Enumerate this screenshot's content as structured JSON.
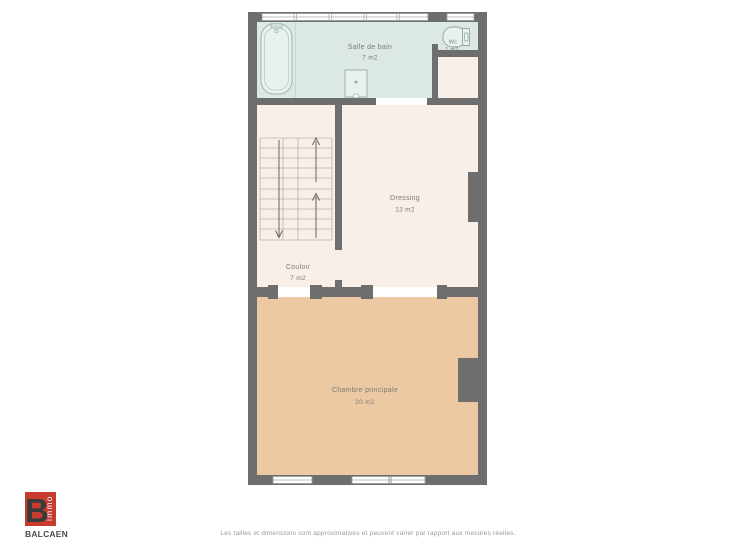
{
  "plan": {
    "rooms": [
      {
        "name": "Salle de bain",
        "area": "7 m2"
      },
      {
        "name": "Wc",
        "area": "1 m2"
      },
      {
        "name": "Dressing",
        "area": "13 m2"
      },
      {
        "name": "Couloir",
        "area": "7 m2"
      },
      {
        "name": "Chambre principale",
        "area": "20 m2"
      }
    ]
  },
  "branding": {
    "logo_letter": "B",
    "logo_wordmark_vertical": "immo",
    "company_name": "BALCAEN"
  },
  "footer": {
    "disclaimer": "Les tailles et dimensions sont approximatives et peuvent varier par rapport aux mesures réelles."
  },
  "colors": {
    "wall": "#6e6e6e",
    "bathroom_floor": "#dbe8e6",
    "hall_floor": "#f7efe8",
    "bedroom_floor": "#edc9a3",
    "door_gap": "#ffffff",
    "window_frame": "#999999",
    "fixture_fill": "#e9f1ef",
    "fixture_stroke": "#9db2b0",
    "stair_line": "#b5b5b5",
    "arrow": "#666666",
    "label": "#7a7a7a",
    "logo_red": "#c63d2f",
    "logo_letter_color": "#3a3a3a",
    "brand_text": "#4a4a4a"
  }
}
